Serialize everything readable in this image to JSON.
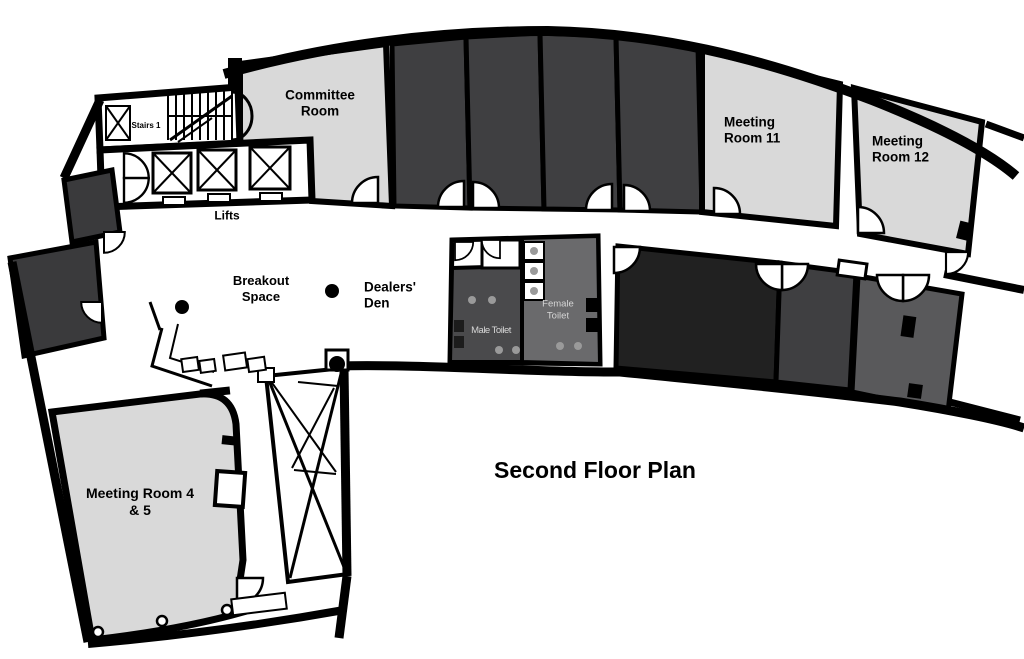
{
  "title": {
    "text": "Second Floor Plan"
  },
  "palette": {
    "background": "#ffffff",
    "wall": "#000000",
    "room_light": "#d9d9d9",
    "room_dark": "#3f3f41",
    "room_dark_left": "#3a3a3c",
    "room_black": "#212121",
    "room_gray": "#59595b",
    "female_toilet_fill": "#6a6a6c",
    "male_toilet_fill": "#4a4a4c",
    "fixture_gray": "#9a9a9a",
    "toilet_label_color": "#d6d6d6"
  },
  "rooms": {
    "stairs_1": {
      "label": "Stairs 1"
    },
    "lifts": {
      "label": "Lifts"
    },
    "committee_room": {
      "label": "Committee Room"
    },
    "meeting_room_11": {
      "label": "Meeting Room 11"
    },
    "meeting_room_12": {
      "label": "Meeting Room 12"
    },
    "breakout_space": {
      "label": "Breakout Space"
    },
    "dealers_den": {
      "label": "Dealers' Den"
    },
    "male_toilet": {
      "label": "Male Toilet"
    },
    "female_toilet": {
      "label": "Female Toilet"
    },
    "meeting_room_4_5": {
      "label": "Meeting Room 4 & 5"
    }
  }
}
